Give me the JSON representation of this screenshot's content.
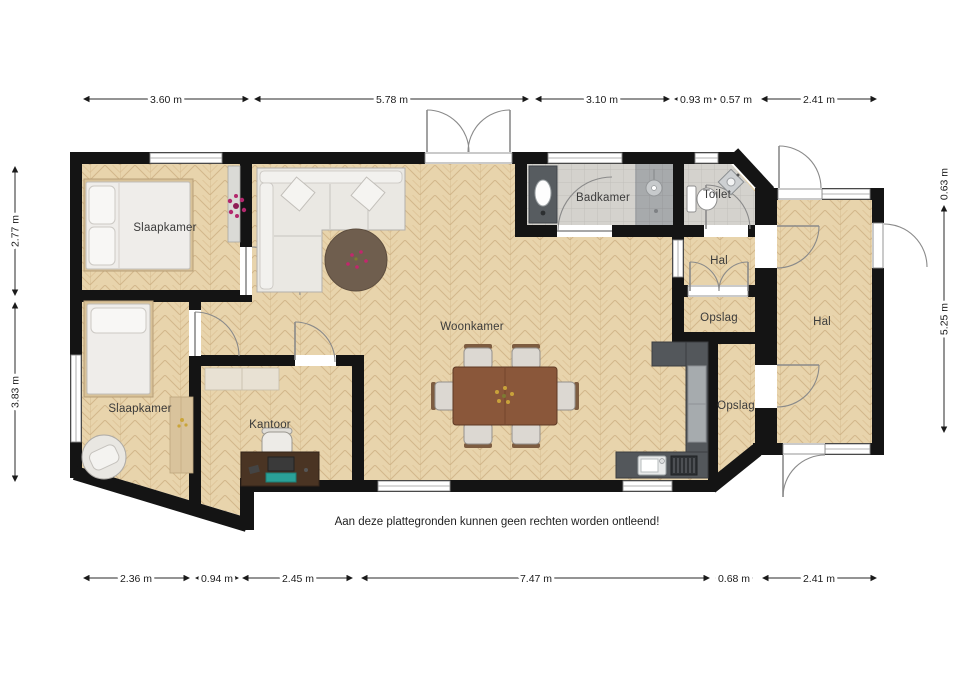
{
  "disclaimer": "Aan deze plattegronden kunnen geen rechten worden ontleend!",
  "rooms": [
    {
      "id": "slaapkamer-1",
      "label": "Slaapkamer"
    },
    {
      "id": "slaapkamer-2",
      "label": "Slaapkamer"
    },
    {
      "id": "kantoor",
      "label": "Kantoor"
    },
    {
      "id": "woonkamer",
      "label": "Woonkamer"
    },
    {
      "id": "badkamer",
      "label": "Badkamer"
    },
    {
      "id": "toilet",
      "label": "Toilet"
    },
    {
      "id": "hal-klein",
      "label": "Hal"
    },
    {
      "id": "opslag-klein",
      "label": "Opslag"
    },
    {
      "id": "opslag",
      "label": "Opslag"
    },
    {
      "id": "hal",
      "label": "Hal"
    }
  ],
  "dimensions": {
    "top": [
      {
        "label": "3.60 m"
      },
      {
        "label": "5.78 m"
      },
      {
        "label": "3.10 m"
      },
      {
        "label": "0.93 m"
      },
      {
        "label": "0.57 m"
      },
      {
        "label": "2.41 m"
      }
    ],
    "bottom": [
      {
        "label": "2.36 m"
      },
      {
        "label": "0.94 m"
      },
      {
        "label": "2.45 m"
      },
      {
        "label": "7.47 m"
      },
      {
        "label": "0.68 m"
      },
      {
        "label": "2.41 m"
      }
    ],
    "left": [
      {
        "label": "2.77 m"
      },
      {
        "label": "3.83 m"
      }
    ],
    "right": [
      {
        "label": "0.63 m"
      },
      {
        "label": "5.25 m"
      }
    ]
  },
  "colors": {
    "wall": "#141414",
    "wood_floor": "#e7d2aa",
    "tile_floor": "#d4d2cd",
    "shower_tile": "#a7aaac",
    "kitchen_counter": "#53575b",
    "table_wood": "#8a573a",
    "rug": "#6f5e4e",
    "plant_accent": "#b3286d"
  }
}
